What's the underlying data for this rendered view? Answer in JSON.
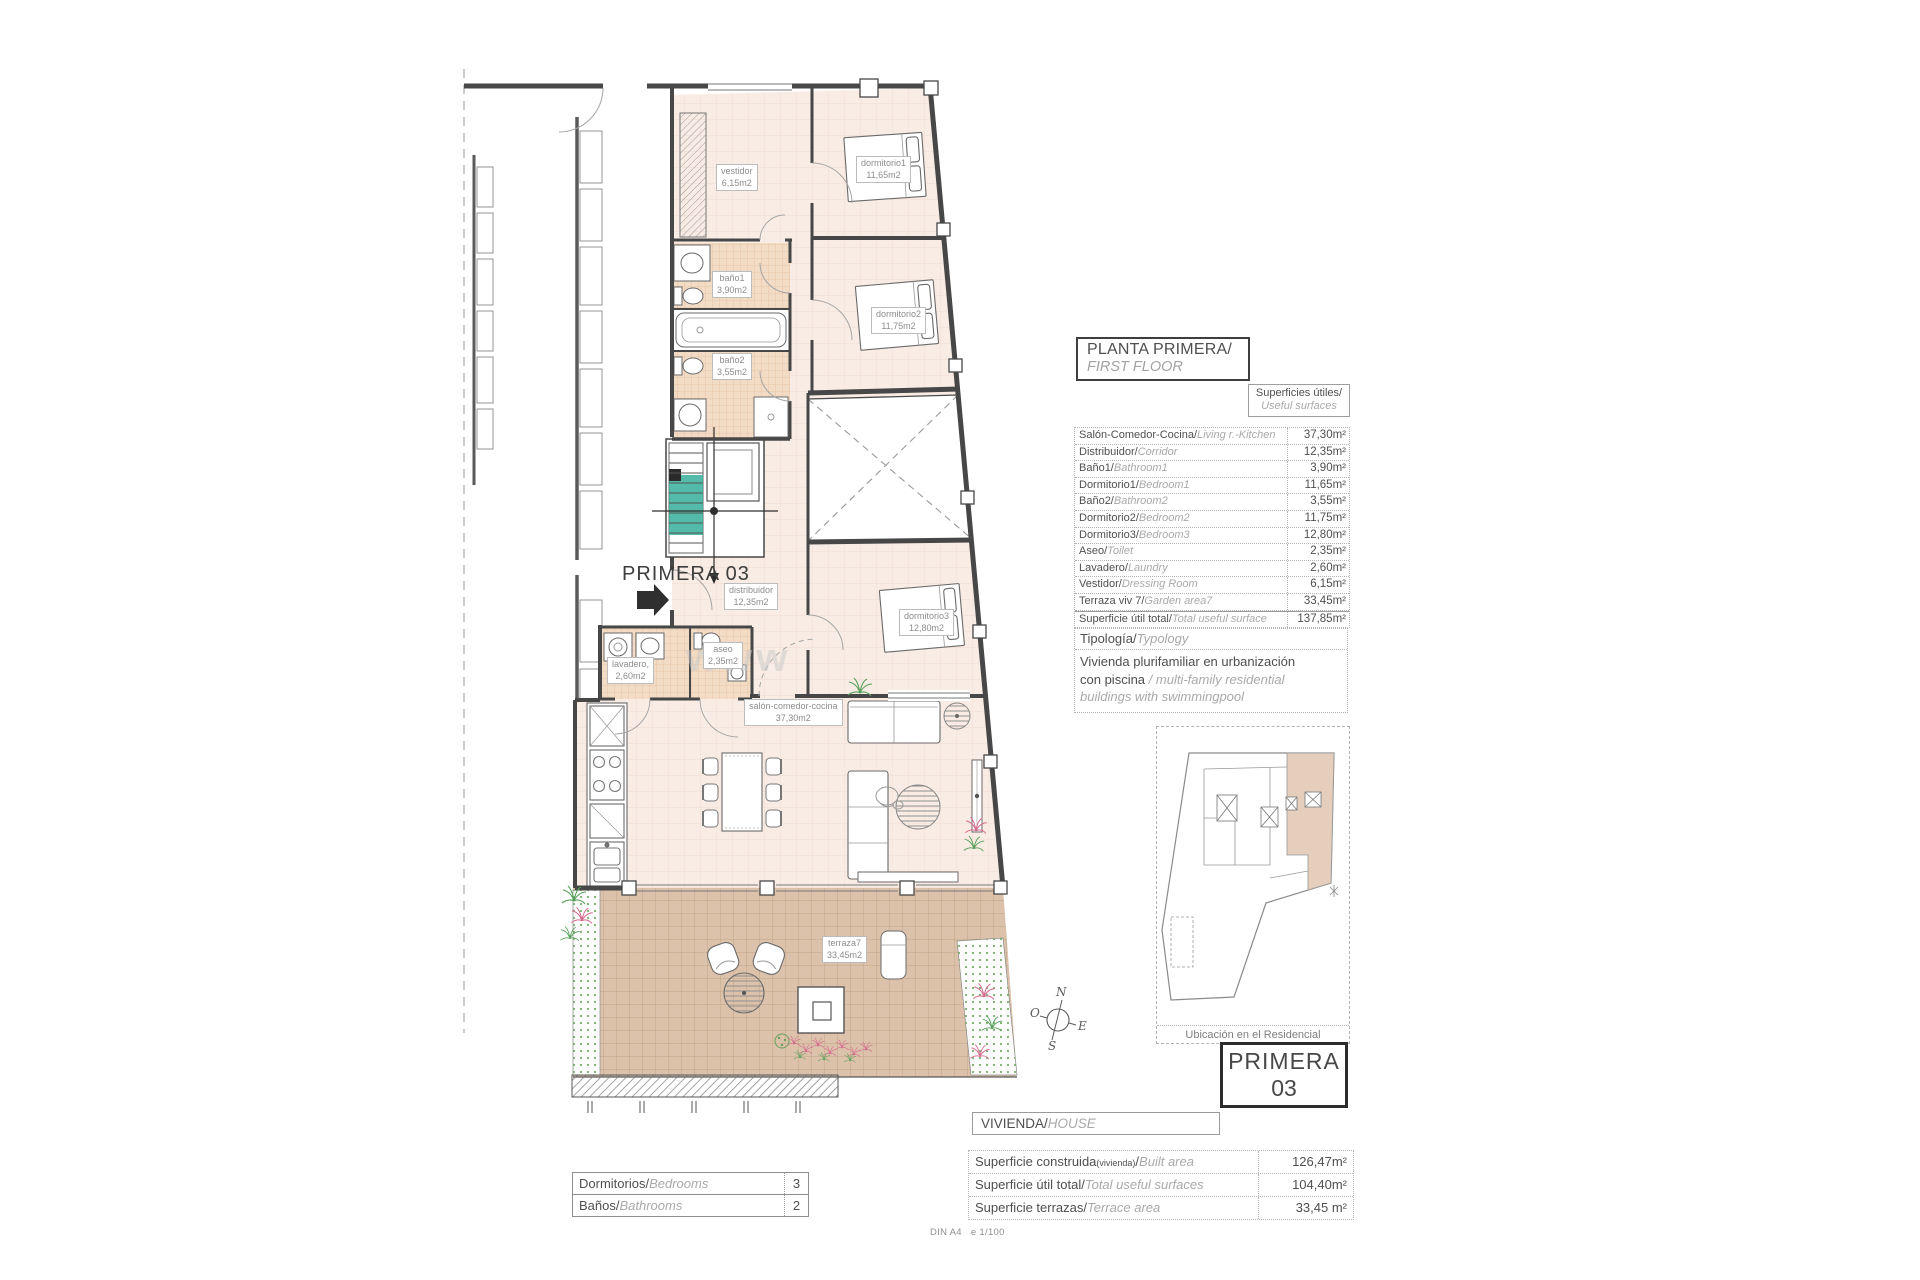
{
  "callout": "PRIMERA 03",
  "watermark": "www",
  "compass": {
    "n": "N",
    "o": "O",
    "e": "E",
    "s": "S"
  },
  "plan_labels": {
    "vestidor": {
      "name": "vestidor",
      "area": "6,15m2"
    },
    "dormitorio1": {
      "name": "dormitorio1",
      "area": "11,65m2"
    },
    "bano1": {
      "name": "baño1",
      "area": "3,90m2"
    },
    "bano2": {
      "name": "baño2",
      "area": "3,55m2"
    },
    "dormitorio2": {
      "name": "dormitorio2",
      "area": "11,75m2"
    },
    "distribuidor": {
      "name": "distribuidor",
      "area": "12,35m2"
    },
    "dormitorio3": {
      "name": "dormitorio3",
      "area": "12,80m2"
    },
    "aseo": {
      "name": "aseo",
      "area": "2,35m2"
    },
    "lavadero": {
      "name": "lavadero,",
      "area": "2,60m2"
    },
    "salon": {
      "name": "salón-comedor-cocina",
      "area": "37,30m2"
    },
    "terraza": {
      "name": "terraza7",
      "area": "33,45m2"
    }
  },
  "title_block": {
    "es": "PLANTA PRIMERA/",
    "en": "FIRST FLOOR"
  },
  "surfaces_box": {
    "es": "Superficies útiles/",
    "en": "Useful surfaces"
  },
  "useful_surfaces": {
    "rows": [
      {
        "es": "Salón-Comedor-Cocina/",
        "en": "Living r.-Kitchen",
        "value": "37,30m²"
      },
      {
        "es": "Distribuidor/",
        "en": "Corridor",
        "value": "12,35m²"
      },
      {
        "es": "Baño1/",
        "en": "Bathroom1",
        "value": "3,90m²"
      },
      {
        "es": "Dormitorio1/",
        "en": "Bedroom1",
        "value": "11,65m²"
      },
      {
        "es": "Baño2/",
        "en": "Bathroom2",
        "value": "3,55m²"
      },
      {
        "es": "Dormitorio2/",
        "en": "Bedroom2",
        "value": "11,75m²"
      },
      {
        "es": "Dormitorio3/",
        "en": "Bedroom3",
        "value": "12,80m²"
      },
      {
        "es": "Aseo/",
        "en": "Toilet",
        "value": "2,35m²"
      },
      {
        "es": "Lavadero/",
        "en": "Laundry",
        "value": "2,60m²"
      },
      {
        "es": "Vestidor/",
        "en": "Dressing Room",
        "value": "6,15m²"
      },
      {
        "es": "Terraza viv 7/",
        "en": "Garden area7",
        "value": "33,45m²"
      },
      {
        "es": "Superficie útil total/",
        "en": "Total useful surface",
        "value": "137,85m²"
      }
    ]
  },
  "typology": {
    "label_es": "Tipología/",
    "label_en": "Typology",
    "line1": "Vivienda plurifamiliar en urbanización",
    "line2_es": "con piscina  ",
    "line2_en": "/ multi-family residential",
    "line3": "buildings with swimmingpool"
  },
  "location": {
    "caption": "Ubicación en el Residencial"
  },
  "unit_box": {
    "line1": "PRIMERA",
    "line2": "03"
  },
  "vivienda_header": {
    "es": "VIVIENDA/",
    "en": "HOUSE"
  },
  "vivienda_table": {
    "rows": [
      {
        "es": "Superficie construida",
        "sub": "(vivienda)",
        "slash": "/",
        "en": "Built area",
        "value": "126,47m²"
      },
      {
        "es": "Superficie útil total/",
        "en": "Total useful surfaces",
        "value": "104,40m²"
      },
      {
        "es": "Superficie terrazas/",
        "en": "Terrace area",
        "value": "33,45 m²"
      }
    ]
  },
  "rooms_count": {
    "rows": [
      {
        "es": "Dormitorios/",
        "en": "Bedrooms",
        "value": "3"
      },
      {
        "es": "Baños/",
        "en": "Bathrooms",
        "value": "2"
      }
    ]
  },
  "footer": {
    "left": "DIN A4",
    "right": "e 1/100"
  }
}
